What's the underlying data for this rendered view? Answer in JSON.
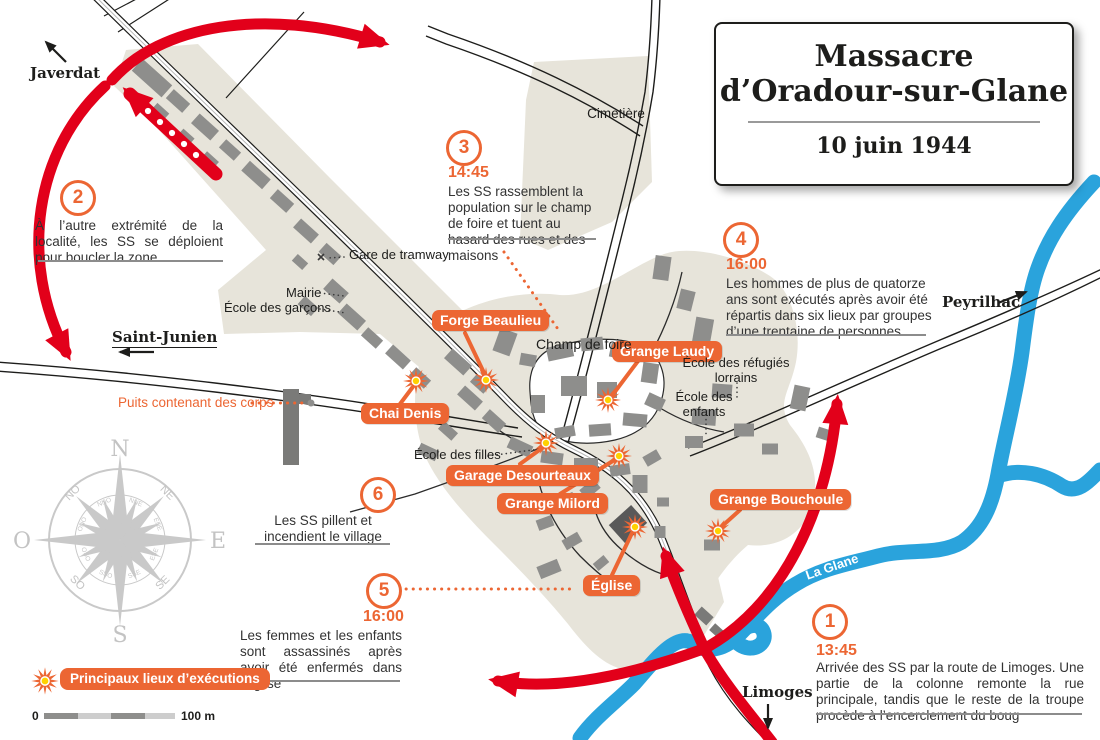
{
  "title": {
    "line1": "Massacre",
    "line2": "d’Oradour-sur-Glane",
    "date": "10 juin 1944"
  },
  "annotations": [
    {
      "num": "1",
      "time": "13:45",
      "text": "Arrivée des SS par la route de Limoges. Une partie de la colonne remonte la rue principale, tandis que le reste de la troupe procède à l’encerclement du boug"
    },
    {
      "num": "2",
      "time": "",
      "text": "À l’autre extrémité de la localité, les SS se déploient pour boucler la zone"
    },
    {
      "num": "3",
      "time": "14:45",
      "text": "Les SS rassemblent la population sur le champ de foire et tuent au hasard des rues et des maisons"
    },
    {
      "num": "4",
      "time": "16:00",
      "text": "Les hommes de plus de quatorze ans sont exécutés après avoir été répartis dans six lieux par groupes d’une trentaine de personnes"
    },
    {
      "num": "5",
      "time": "16:00",
      "text": "Les femmes et les enfants sont assassinés après avoir été enfermés dans l’église"
    },
    {
      "num": "6",
      "time": "",
      "text": "Les SS pillent et incendient le village"
    }
  ],
  "sites": [
    {
      "label": "Forge Beaulieu"
    },
    {
      "label": "Chai Denis"
    },
    {
      "label": "Grange Laudy"
    },
    {
      "label": "Garage Desourteaux"
    },
    {
      "label": "Grange Milord"
    },
    {
      "label": "Grange Bouchoule"
    },
    {
      "label": "Église"
    }
  ],
  "places": {
    "cimetiere": "Cimetière",
    "gare": "Gare de tramway",
    "mairie": "Mairie",
    "ecole_garcons": "École des garçons",
    "champ_de_foire": "Champ de foire",
    "ecole_refugies": "École des réfugiés lorrains",
    "ecole_enfants": "École des enfants",
    "ecole_filles": "École des filles",
    "puits": "Puits contenant des corps"
  },
  "directions": {
    "javerdat": "Javerdat",
    "saint_junien": "Saint-Junien",
    "peyrilhac": "Peyrilhac",
    "limoges": "Limoges"
  },
  "river_label": "La Glane",
  "compass": {
    "cardinals": {
      "n": "N",
      "e": "E",
      "s": "S",
      "o": "O"
    },
    "intercardinals": {
      "ne": "NE",
      "no": "NO",
      "se": "SE",
      "so": "SO"
    },
    "tertiary": {
      "nne": "NNE",
      "ene": "ENE",
      "ese": "ESE",
      "sse": "SSE",
      "sso": "SSO",
      "oso": "OSO",
      "ono": "ONO",
      "nno": "NNO"
    }
  },
  "legend": {
    "executions": "Principaux lieux d’exécutions"
  },
  "scale": {
    "zero": "0",
    "hundred": "100 m"
  },
  "colors": {
    "red": "#e2001a",
    "orange": "#ec6633",
    "blue": "#2aa3dc",
    "beige": "#e7e4da",
    "building": "#8e8e8c"
  }
}
